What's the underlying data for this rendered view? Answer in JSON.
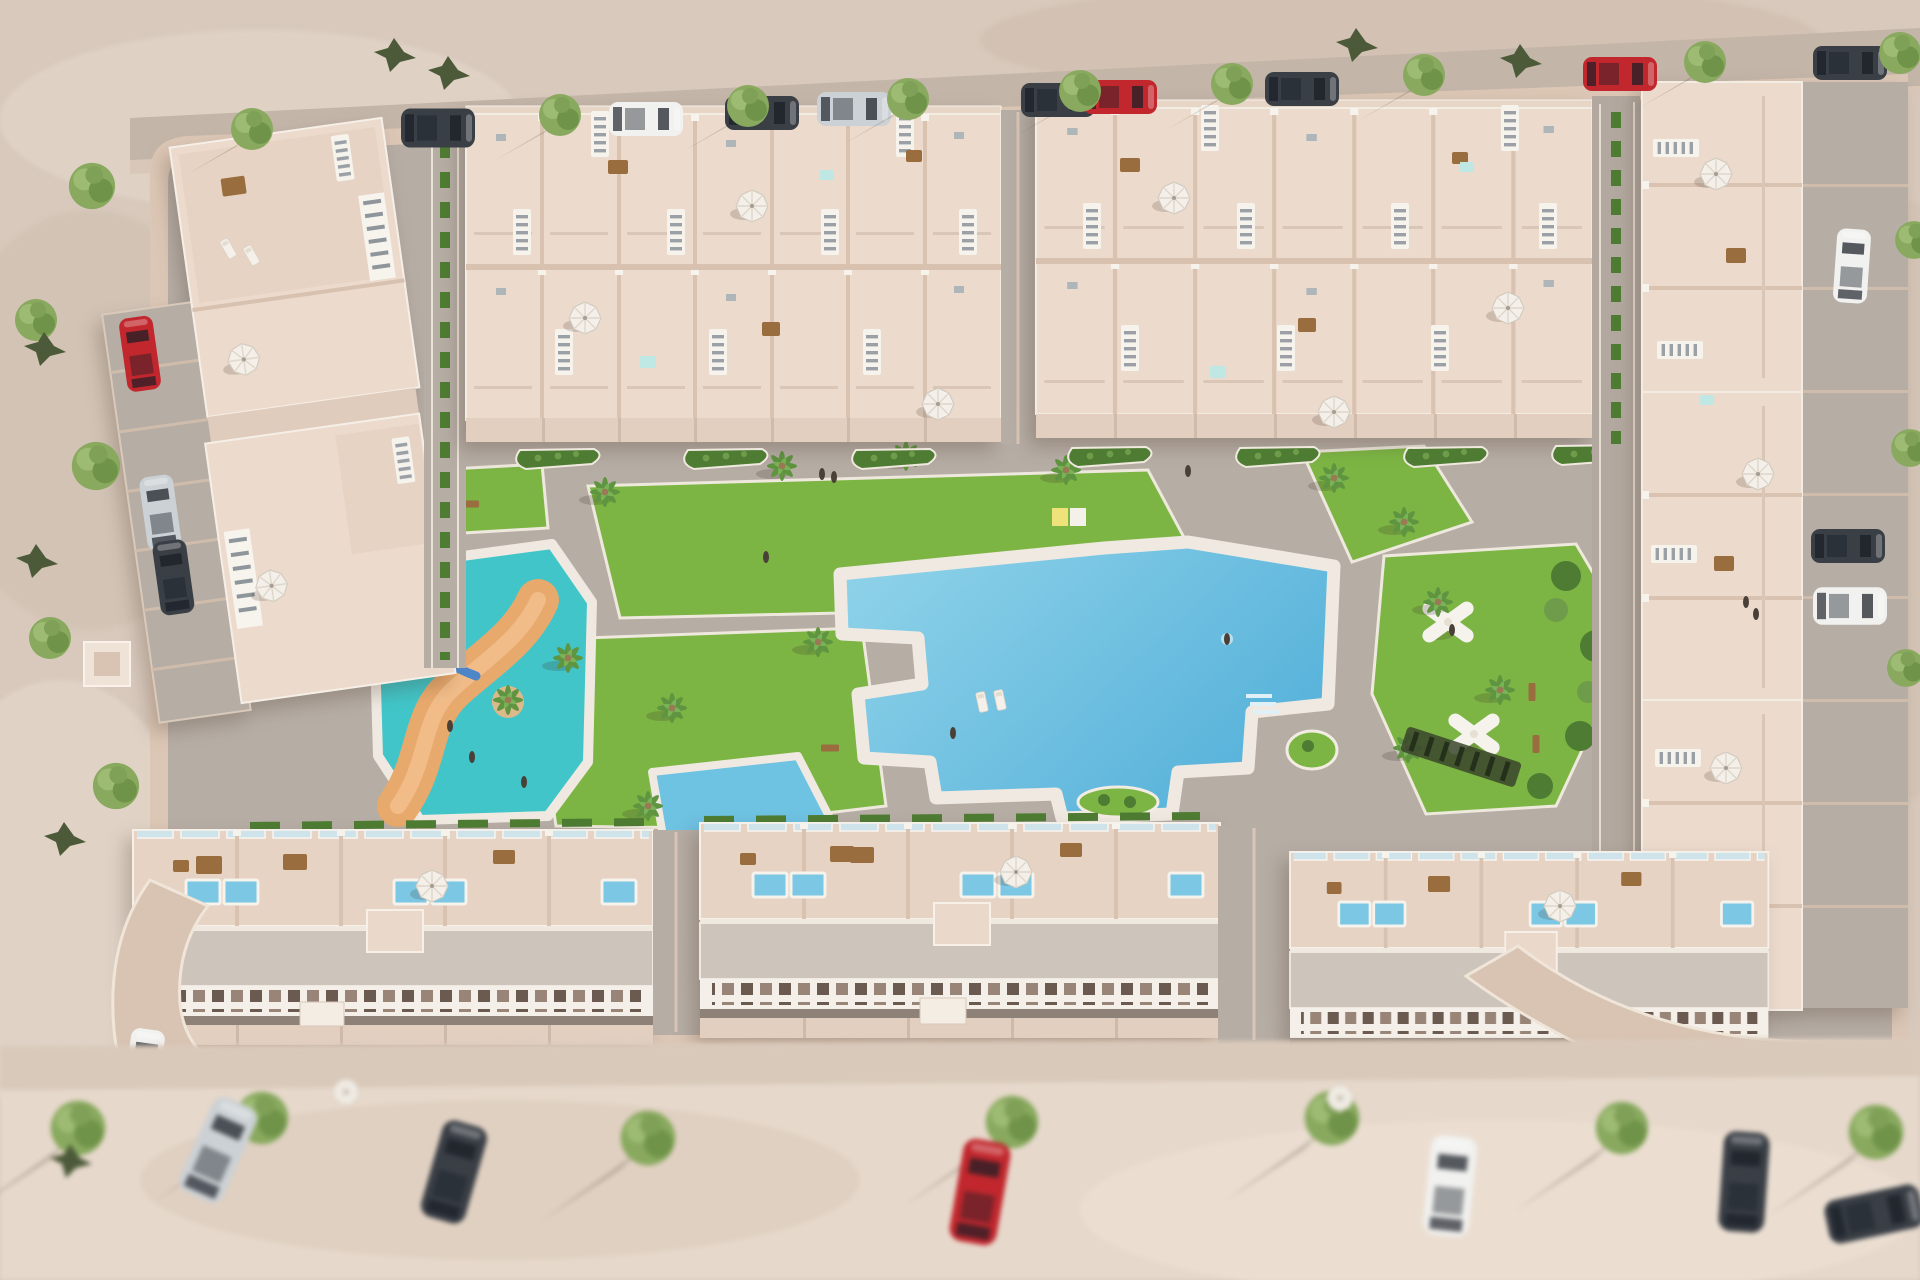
{
  "scene": {
    "description": "Aerial 3D architectural rendering of a beige Mediterranean residential development: rows of townhouses with rooftop solariums surround a central communal area containing a large free-form swimming pool, a turquoise children's splash pool with a sandy lazy-river ribbon and water slide, bright lawns with palm trees, and a garden with two white X-shaped pergolas; perimeter streets are lined with parked cars and round green trees.",
    "style": "architectural-visualization",
    "time_of_day": "day"
  },
  "palette": {
    "sand": "#d8c9bc",
    "sand_bottom": "#e6d8cb",
    "road": "#c3b5a8",
    "sidewalk": "#dcc6b5",
    "pavement": "#b6ada5",
    "wall": "#ecdacc",
    "wall_edge": "#f6f0e8",
    "terrace": "#e6d3c4",
    "roof": "#cdc4bb",
    "balcony": "#f4efe8",
    "patio": "#e2cfc0",
    "lawn": "#7cb544",
    "hedge": "#4e7c33",
    "tree": "#88a95e",
    "palm": "#5f9440",
    "cone_bush": "#4c5a39",
    "pool": "#57b2da",
    "pool_light": "#92d4ea",
    "plunge": "#7cc8e4",
    "deck": "#efe9e1",
    "kids_pool": "#41c5c8",
    "river": "#e8a96d",
    "umbrella": "#f4f0e9",
    "wood": "#9a6d3f",
    "glass": "#cfe3ea",
    "window": "#6b5a50",
    "car_red": "#c1272d",
    "car_silver": "#ccd1d5",
    "car_dark": "#3a3f46",
    "car_white": "#f1f1ef"
  },
  "features": [
    "two large top townhouse blocks with rooftop solariums and white stair railings",
    "left cluster of apartment buildings with roof terraces and parked cars",
    "right-hand column of townhouses with driveways and parked cars",
    "three long bottom townhouse rows with rooftop plunge pools and white balcony bands",
    "free-form communal swimming pool with white deck, steps and planted islands",
    "children's splash pool with lazy-river ribbon, water slide and palm island",
    "pergola garden with two white X-shaped pergolas and curved shrub beds",
    "green lawns edged in white with palm trees, benches and sunbathers",
    "perimeter roads with parked cars, street trees and dark shrubs",
    "blurred sandy foreground street with trees and parked cars"
  ],
  "counts": {
    "top_townhouse_blocks": 2,
    "bottom_townhouse_rows": 3,
    "left_apartment_buildings": 2,
    "right_townhouse_columns": 1,
    "main_pools": 1,
    "kids_splash_pools": 1,
    "pergolas": 2,
    "white_umbrellas": 15,
    "street_trees_along_top_road": 9
  }
}
